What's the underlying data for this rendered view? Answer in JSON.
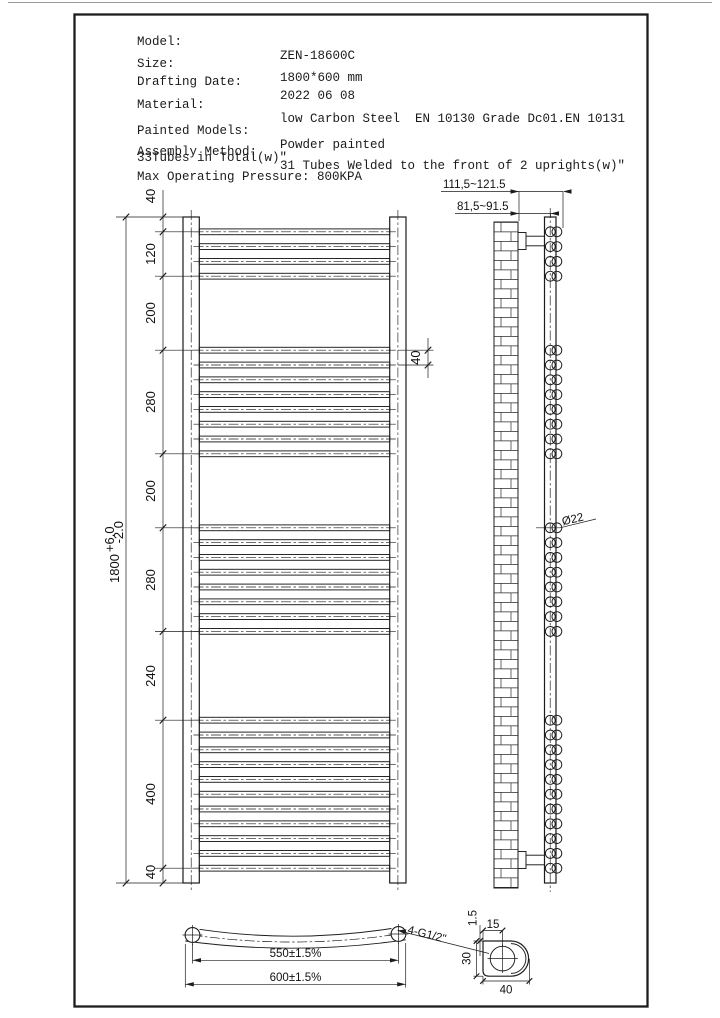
{
  "colors": {
    "ink": "#1c1c1c",
    "background": "#ffffff"
  },
  "specs": {
    "rows": [
      {
        "label": "Model:",
        "value": "ZEN-18600C"
      },
      {
        "label": "Size:",
        "value": "1800*600 mm"
      },
      {
        "label": "Drafting Date:",
        "value": "2022 06 08"
      },
      {
        "label": "Material:",
        "value": "low Carbon Steel  EN 10130 Grade Dc01.EN 10131"
      },
      {
        "label": "Painted Models:",
        "value": "Powder painted"
      },
      {
        "label": "Assembly Method:",
        "value": "31 Tubes Welded to the front of 2 uprights(w)\""
      }
    ],
    "note_line": "33Tubes in Total(w)\"",
    "pressure_line": "Max Operating Pressure: 800KPA"
  },
  "front_view": {
    "overall_height": "1800",
    "tol_plus": "+6.0",
    "tol_minus": "-2.0",
    "segments": [
      "40",
      "120",
      "200",
      "280",
      "200",
      "280",
      "240",
      "400",
      "40"
    ],
    "tube_pitch": "40",
    "tube_groups": [
      4,
      8,
      8,
      11
    ]
  },
  "side_view": {
    "wall_to_tube_face": "111,5~121.5",
    "wall_to_upright": "81,5~91.5",
    "tube_diameter": "Ø22"
  },
  "bottom_view": {
    "centres": "550±1.5%",
    "overall_width": "600±1.5%",
    "connections": "4-G1/2\""
  },
  "detail": {
    "thickness": "1.5",
    "offset": "15",
    "depth": "30",
    "width": "40"
  }
}
